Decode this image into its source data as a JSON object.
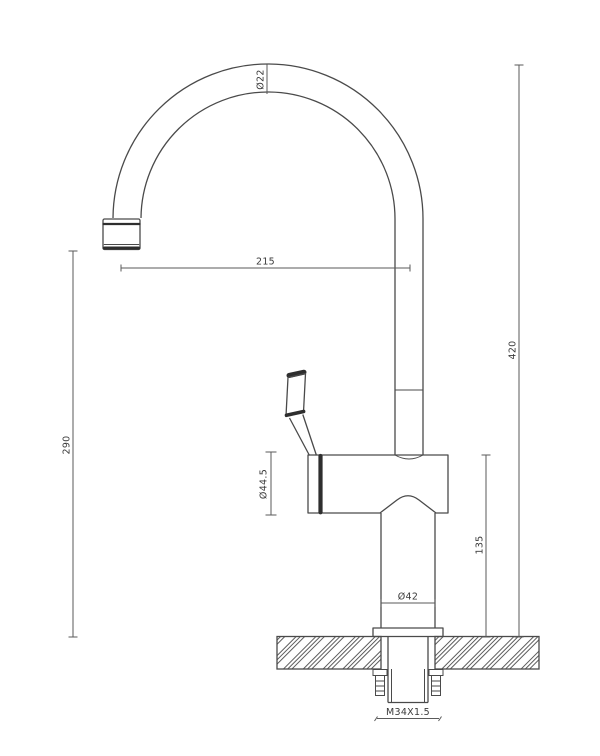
{
  "drawing": {
    "type": "faucet-installation-technical-drawing",
    "colors": {
      "outline": "#4a4a4a",
      "dark_band": "#2e2e2e",
      "dimension_line": "#5a5a5a",
      "dimension_text": "#3a3a3a",
      "background": "#ffffff"
    },
    "dimensions": {
      "spout_tube_diameter": "Ø22",
      "spout_reach": "215",
      "outlet_height": "290",
      "total_height": "420",
      "body_diameter": "Ø44.5",
      "base_height": "135",
      "base_diameter": "Ø42",
      "thread_spec": "M34X1.5"
    }
  }
}
